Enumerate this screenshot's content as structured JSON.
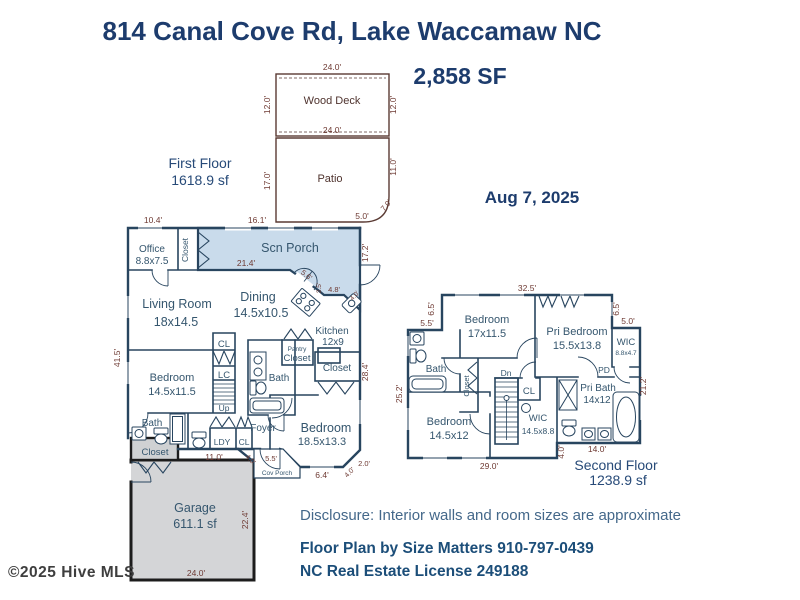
{
  "header": {
    "title": "814 Canal Cove Rd, Lake Waccamaw NC",
    "total_area": "2,858 SF",
    "date": "Aug 7, 2025"
  },
  "outdoor": {
    "wood_deck": {
      "name": "Wood Deck",
      "dim_top": "24.0'",
      "dim_left": "12.0'",
      "dim_right": "12.0'",
      "dim_bottom": "24.0'"
    },
    "patio": {
      "name": "Patio",
      "dim_left": "17.0'",
      "dim_right": "11.0'",
      "dim_curve": "7.0'",
      "dim_bottom": "5.0'"
    }
  },
  "first_floor": {
    "label": "First Floor",
    "area": "1618.9 sf",
    "rooms": {
      "office": {
        "name": "Office",
        "dims": "8.8x7.5"
      },
      "hall_closet": {
        "name": "Closet"
      },
      "scn_porch": {
        "name": "Scn Porch"
      },
      "living_room": {
        "name": "Living Room",
        "dims": "18x14.5"
      },
      "dining": {
        "name": "Dining",
        "dims": "14.5x10.5"
      },
      "kitchen": {
        "name": "Kitchen",
        "dims": "12x9"
      },
      "bedroom_left": {
        "name": "Bedroom",
        "dims": "14.5x11.5"
      },
      "bedroom_right": {
        "name": "Bedroom",
        "dims": "18.5x13.3"
      },
      "foyer": {
        "name": "Foyer"
      },
      "bath_center": {
        "name": "Bath"
      },
      "bath_left": {
        "name": "Bath"
      },
      "pantry": {
        "line1": "Pantry",
        "line2": "Closet"
      },
      "closet_right": {
        "name": "Closet"
      },
      "garage_closet": {
        "name": "Closet"
      },
      "laundry": {
        "name": "LDY"
      },
      "laundry_closet": {
        "name": "CL"
      },
      "closet_cl": {
        "name": "CL"
      },
      "linen_lc": {
        "name": "LC"
      },
      "stairs": {
        "name": "Up"
      },
      "cov_porch": {
        "name": "Cov Porch"
      },
      "garage": {
        "name": "Garage",
        "area": "611.1 sf"
      }
    },
    "dims": {
      "top_left": "10.4'",
      "top_mid": "16.1'",
      "porch_width": "21.4'",
      "porch_diag": "5.6'",
      "kitchen_side": "2.5'",
      "kitchen_top": "4.8'",
      "kitchen_diag": "4.0'",
      "porch_right": "17.2'",
      "left_side": "41.5'",
      "right_side": "28.4'",
      "bottom_hall": "11.0'",
      "foyer_diag": "4.0'",
      "cov_porch_top": "5.5'",
      "bay_bottom": "6.4'",
      "bay_diag": "4.0'",
      "bay_right": "2.0'",
      "garage_right": "22.4'",
      "garage_bottom": "24.0'"
    }
  },
  "second_floor": {
    "label": "Second Floor",
    "area": "1238.9 sf",
    "rooms": {
      "bedroom_top": {
        "name": "Bedroom",
        "dims": "17x11.5"
      },
      "pri_bedroom": {
        "name": "Pri Bedroom",
        "dims": "15.5x13.8"
      },
      "wic_small": {
        "name": "WIC",
        "dims": "8.8x4.7"
      },
      "bath": {
        "name": "Bath"
      },
      "closet_strip": {
        "name": "Closet"
      },
      "stairs": {
        "name": "Dn"
      },
      "closet_cl": {
        "name": "CL"
      },
      "pocket_door": {
        "name": "PD"
      },
      "pri_bath": {
        "name": "Pri Bath",
        "dims": "14x12"
      },
      "bedroom_bottom": {
        "name": "Bedroom",
        "dims": "14.5x12"
      },
      "wic_large": {
        "name": "WIC",
        "dims": "14.5x8.8"
      }
    },
    "dims": {
      "top": "32.5'",
      "top_left_side": "6.5'",
      "left_step": "5.5'",
      "top_right_side": "6.5'",
      "right_step": "5.0'",
      "left_side": "25.2'",
      "right_side": "21.2'",
      "bottom": "29.0'",
      "pri_bath_bottom": "14.0'",
      "right_drop": "4.0'"
    }
  },
  "footer": {
    "disclosure": "Disclosure: Interior walls and room sizes are approximate",
    "credit_line1": "Floor Plan by Size Matters 910-797-0439",
    "credit_line2": "NC Real Estate License 249188",
    "watermark": "©2025 Hive MLS"
  },
  "colors": {
    "heading": "#1d3c6d",
    "wall": "#28455f",
    "dimension": "#6e3a33",
    "room_label": "#35566e",
    "porch_fill": "#c9dbeb",
    "garage_fill": "#d4d5d7",
    "outdoor_outline": "#5a3a33",
    "credits": "#1c4e79",
    "disclosure": "#44688a",
    "watermark": "#3e3e3e"
  }
}
